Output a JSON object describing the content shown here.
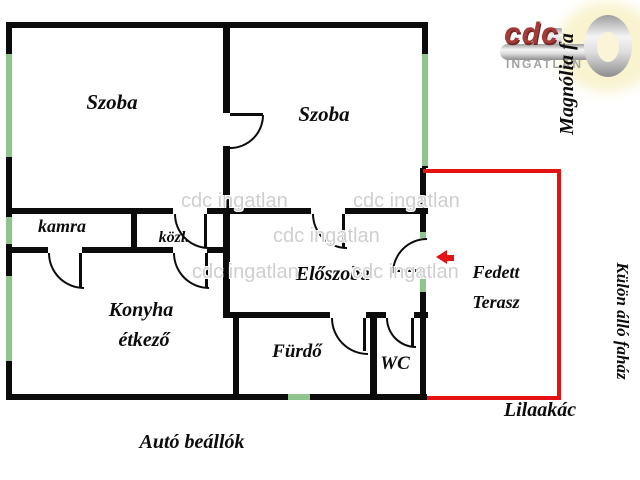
{
  "labels": {
    "szoba1": "Szoba",
    "szoba2": "Szoba",
    "kamra": "kamra",
    "kozl": "közl.",
    "eloszoba": "Előszoba",
    "konyha_line1": "Konyha",
    "konyha_line2": "étkező",
    "furdo": "Fürdő",
    "wc": "WC",
    "terasz_line1": "Fedett",
    "terasz_line2": "Terasz",
    "lilaakac": "Lilaakác",
    "auto_beallok": "Autó beállók",
    "magnolia": "Magnólia fa",
    "kulon_fahaz": "Külön álló faház"
  },
  "logo": {
    "brand": "cdc",
    "subtitle": "INGATLAN",
    "key_icon": "key-icon"
  },
  "watermark": {
    "text": "cdc ingatlan"
  },
  "colors": {
    "wall": "#0b0b0b",
    "window_green": "#8fc48f",
    "terrace_red": "#e41212",
    "brand_red": "#a33c38",
    "subtitle_gray": "#a2a2a2",
    "watermark_gray": "#cfcfcf",
    "key_glow": "#f9f3cf"
  }
}
